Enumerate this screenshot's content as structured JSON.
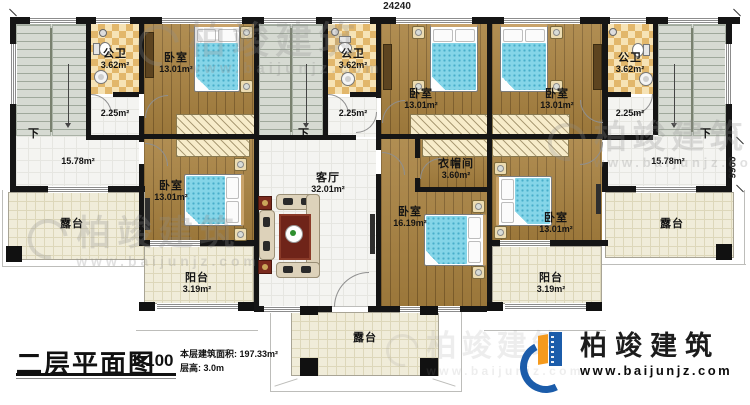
{
  "dimensions": {
    "top": "24240",
    "right": "9900"
  },
  "rooms": {
    "bath_left": {
      "label": "公卫",
      "area": "3.62m²"
    },
    "bed_tl": {
      "label": "卧室",
      "area": "13.01m²"
    },
    "hall_small_left": {
      "area": "2.25m²"
    },
    "hall_left": {
      "area": "15.78m²"
    },
    "stair_left": {
      "down": "下"
    },
    "terrace_left": {
      "label": "露台"
    },
    "bed_bl": {
      "label": "卧室",
      "area": "13.01m²"
    },
    "balcony_left": {
      "label": "阳台",
      "area": "3.19m²"
    },
    "bath_mid": {
      "label": "公卫",
      "area": "3.62m²"
    },
    "hall_small_mid": {
      "area": "2.25m²"
    },
    "stair_mid": {
      "down": "下"
    },
    "living": {
      "label": "客厅",
      "area": "32.01m²"
    },
    "bed_3": {
      "label": "卧室",
      "area": "13.01m²"
    },
    "bed_4": {
      "label": "卧室",
      "area": "13.01m²"
    },
    "cloak": {
      "label": "衣帽间",
      "area": "3.60m²"
    },
    "bed_16": {
      "label": "卧室",
      "area": "16.19m²"
    },
    "bed_5": {
      "label": "卧室",
      "area": "13.01m²"
    },
    "balcony_right": {
      "label": "阳台",
      "area": "3.19m²"
    },
    "bath_right": {
      "label": "公卫",
      "area": "3.62m²"
    },
    "hall_small_right": {
      "area": "2.25m²"
    },
    "stair_right": {
      "down": "下"
    },
    "hall_right": {
      "area": "15.78m²"
    },
    "terrace_right": {
      "label": "露台"
    },
    "terrace_bottom": {
      "label": "露台"
    }
  },
  "title_block": {
    "title": "二层平面图",
    "scale": "1:100",
    "area_line": "本层建筑面积: 197.33m²",
    "height_line": "层高: 3.0m"
  },
  "logo": {
    "name": "柏竣建筑",
    "url": "www.baijunjz.com"
  },
  "watermark": {
    "name": "柏竣建筑",
    "url": "www.baijunjz.com"
  },
  "colors": {
    "wall": "#151515",
    "wood_floor": "#a8813f",
    "bath_tile": "#e2b76b",
    "bed_blue": "#85d5e8",
    "terrace": "#f0ecd9",
    "rug_red": "#6f2419",
    "logo_blue": "#1b5caa",
    "logo_orange": "#f59a1d"
  }
}
